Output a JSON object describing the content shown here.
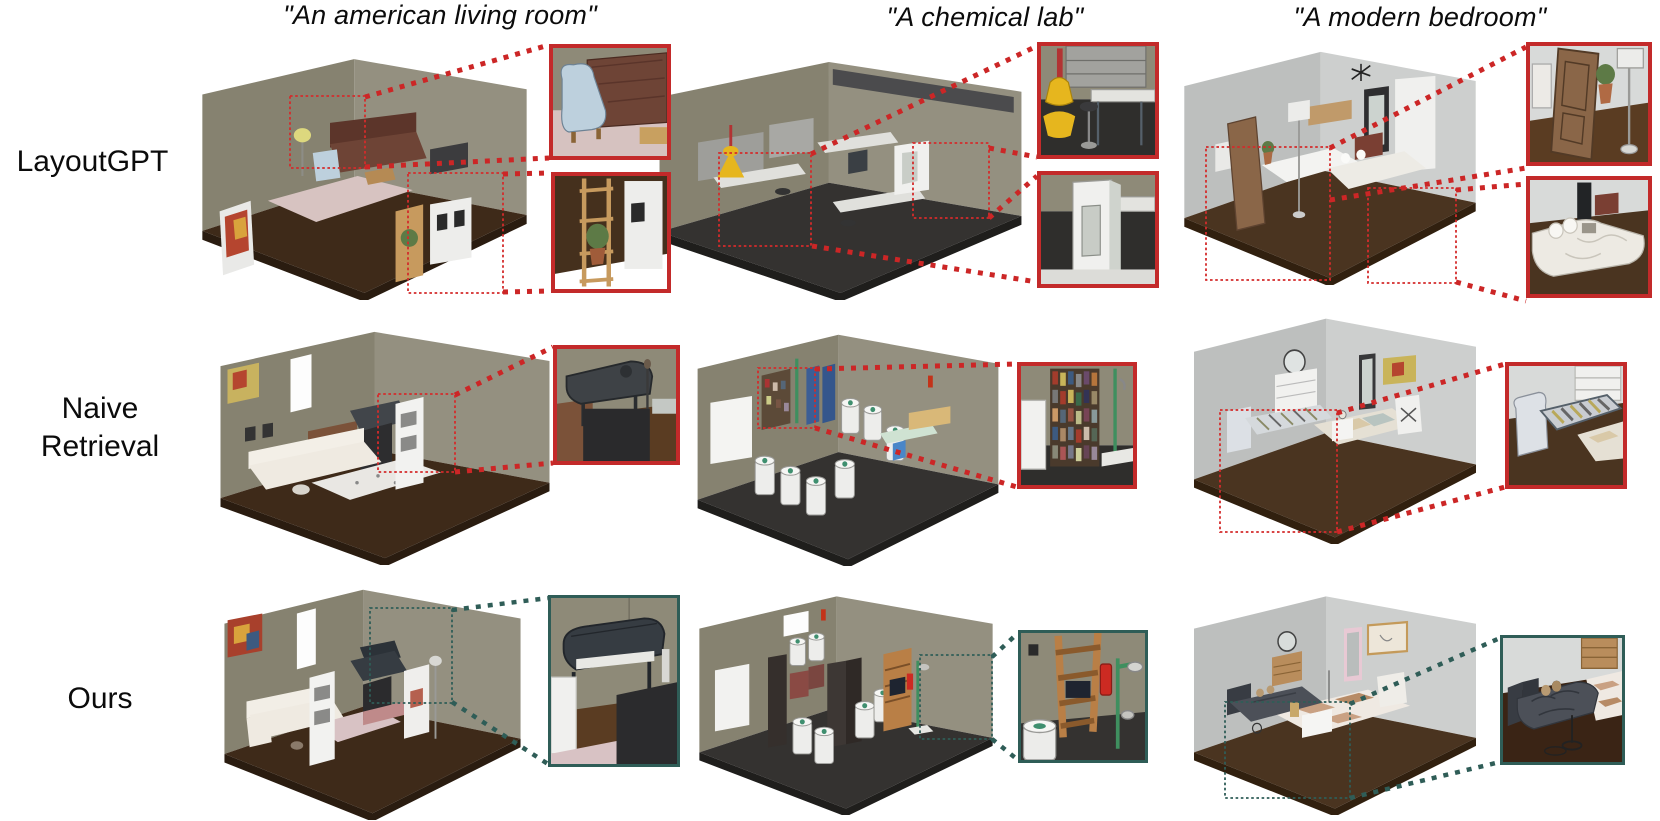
{
  "figure": {
    "prompts": [
      "\"An american living room\"",
      "\"A chemical lab\"",
      "\"A modern bedroom\""
    ],
    "methods": [
      "LayoutGPT",
      "Naive Retrieval",
      "Ours"
    ],
    "colors": {
      "background": "#ffffff",
      "text": "#0b0b0b",
      "highlight_red": "#c32a2a",
      "highlight_teal": "#2f5d57",
      "wall_olive_left": "#868270",
      "wall_olive_right": "#94907e",
      "wall_gray_left": "#bdbfbe",
      "wall_gray_right": "#cdcfce",
      "floor_brown": "#3e2a19",
      "floor_lab_dark": "#343230"
    },
    "cells": {
      "r1c1": {
        "method": "LayoutGPT",
        "prompt": "An american living room",
        "highlight": "red",
        "description": "Isometric living room with brown leather sofa overlapped by a light-blue armchair on a pink rug, floor lamp, dark console, wooden shelf with plant and leaning white art panels; two red dotted regions zoomed."
      },
      "r1c2": {
        "method": "LayoutGPT",
        "prompt": "A chemical lab",
        "highlight": "red",
        "description": "Isometric lab with dark speckled floor, steel benches with white tops, gray shelving, yellow cone lamp, stools and a white cabinet; two red dotted regions zoomed."
      },
      "r1c3": {
        "method": "LayoutGPT",
        "prompt": "A modern bedroom",
        "highlight": "red",
        "description": "Isometric bedroom with leaning wooden door, potted plant, floor lamp through the mattress, sideboard, dark mirror, white wardrobe and a bed with crumpled duvet; two red dotted regions zoomed."
      },
      "r2c1": {
        "method": "Naive Retrieval",
        "prompt": "An american living room",
        "highlight": "red",
        "description": "Living room with long white sofa, speckled rug, brown console, dark TV slab, grand piano and tall white shelf tower; one red dotted region zoomed on the piano."
      },
      "r2c2": {
        "method": "Naive Retrieval",
        "prompt": "A chemical lab",
        "highlight": "red",
        "description": "Lab with white fridge, cluttered bookshelf, blue cabinets, many white storage cylinders, green-topped bench, wooden desk and blue chair; one red dotted region zoomed on the bookshelf."
      },
      "r2c3": {
        "method": "Naive Retrieval",
        "prompt": "A modern bedroom",
        "highlight": "red",
        "description": "Bedroom with bare bed frame without mattress, white dresser with round mirror, colorful rug, nightstand, tall mirror, painting and fan; one red dotted region zoomed on the empty bed frame."
      },
      "r3c1": {
        "method": "Ours",
        "prompt": "An american living room",
        "highlight": "teal",
        "description": "Living room with white sectional sofa, shelf tower, grand piano, TV, pink rug and bench, tilted painting and projector screen; one teal dotted region zoomed on the piano and TV."
      },
      "r3c2": {
        "method": "Ours",
        "prompt": "A chemical lab",
        "highlight": "teal",
        "description": "Lab with white cylinders, dark cabinets, red-framed rigs, fridge and a wooden ladder shelf holding a laptop beside a red fire extinguisher and green emergency shower; one teal dotted region zoomed."
      },
      "r3c3": {
        "method": "Ours",
        "prompt": "A modern bedroom",
        "highlight": "teal",
        "description": "Bedroom with dark gray bed, wooden dresser with round mirror, checkered rug, white coffee table, armchair, pink-framed mirror and pin board; one teal dotted region zoomed on the bed."
      }
    },
    "insets": {
      "i1": "close-up of brown leather sofa and light-blue armchair",
      "i2": "close-up of wooden ladder shelf with plant and art panel",
      "i3": "close-up of yellow cone lamp, shelving and bench",
      "i4": "close-up of white cabinet beside bench",
      "i5": "close-up of leaning door, plant and floor lamp",
      "i6": "close-up of bed with pillows, duvet and painting",
      "i7": "close-up of grand piano above TV slab",
      "i8": "close-up of cluttered bookshelf and fridge",
      "i9": "close-up of bare bed frame and dresser",
      "i10": "close-up of grand piano and TV",
      "i11": "close-up of wooden shelf, fire extinguisher, shower and cylinder",
      "i12": "close-up of dark bed, dresser and checkered rug"
    }
  }
}
